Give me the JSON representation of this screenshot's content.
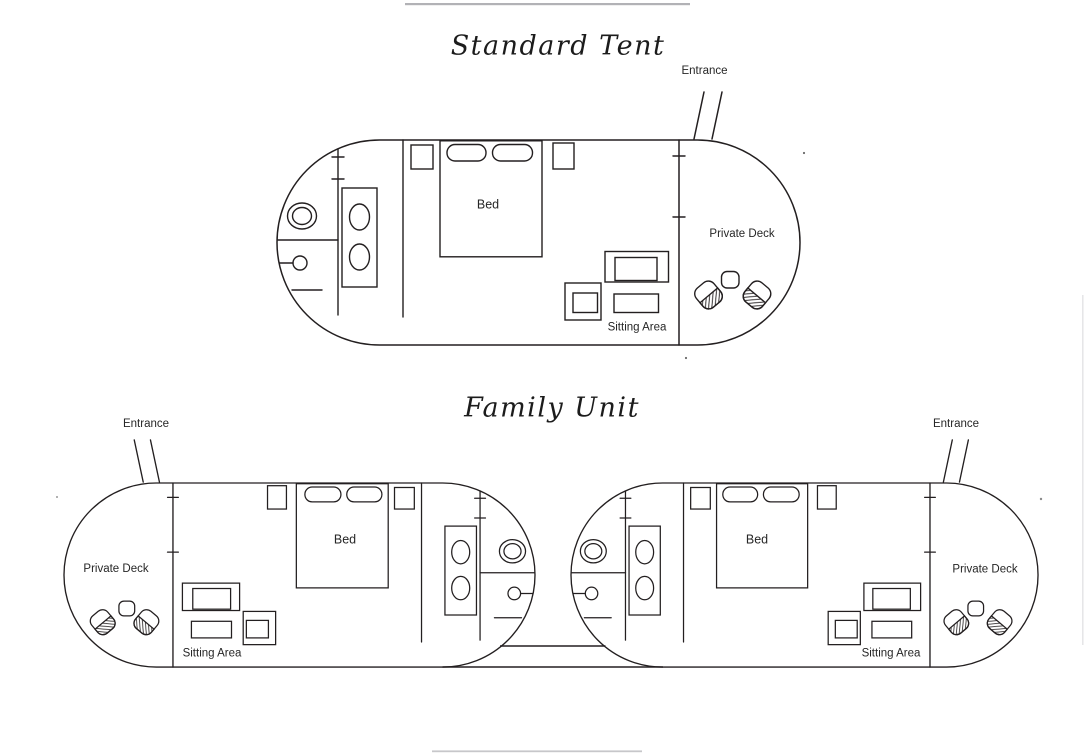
{
  "page": {
    "background": "#ffffff",
    "ink_color": "#231f20",
    "artifact_gray": "#b2b2b6"
  },
  "titles": {
    "standard": "Standard Tent",
    "family": "Family Unit"
  },
  "tents": [
    {
      "name": "standard-tent",
      "labels": {
        "entrance": "Entrance",
        "bed": "Bed",
        "sitting": "Sitting Area",
        "deck": "Private Deck"
      }
    },
    {
      "name": "family-left-tent",
      "labels": {
        "entrance": "Entrance",
        "bed": "Bed",
        "sitting": "Sitting Area",
        "deck": "Private Deck"
      }
    },
    {
      "name": "family-right-tent",
      "labels": {
        "entrance": "Entrance",
        "bed": "Bed",
        "sitting": "Sitting Area",
        "deck": "Private Deck"
      }
    }
  ]
}
